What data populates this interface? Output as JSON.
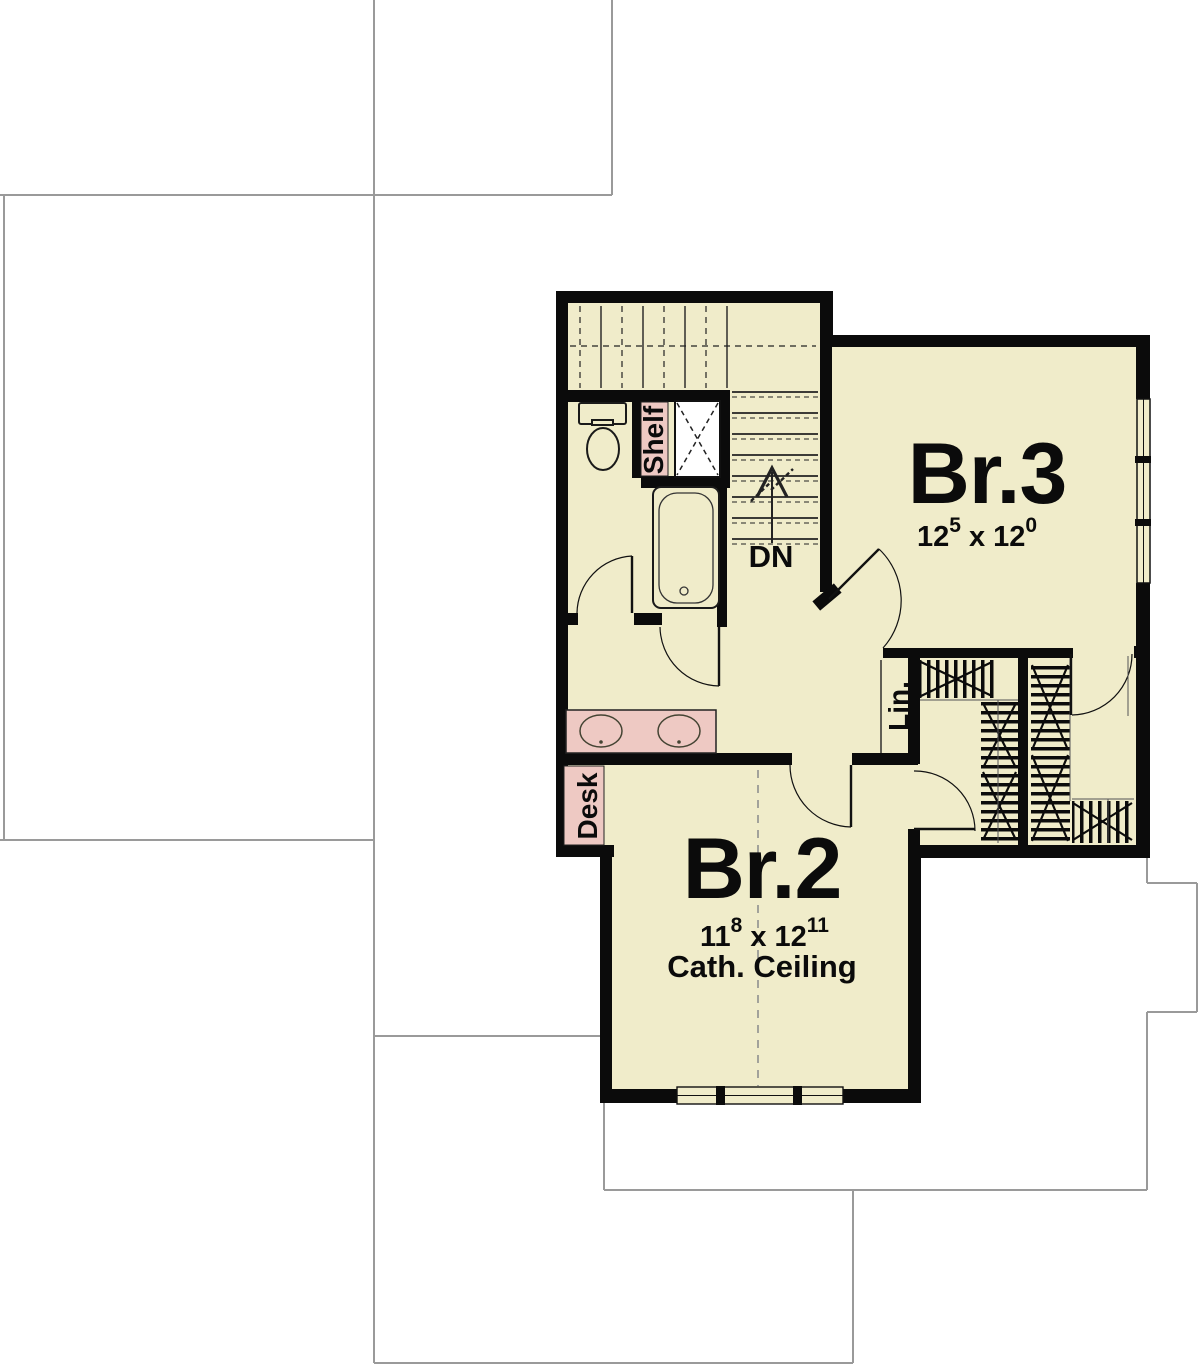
{
  "plan": {
    "rooms": {
      "br3": {
        "name": "Br.3",
        "dim_a": "12",
        "dim_a_sup": "5",
        "dim_sep": "x",
        "dim_b": "12",
        "dim_b_sup": "0"
      },
      "br2": {
        "name": "Br.2",
        "dim_a": "11",
        "dim_a_sup": "8",
        "dim_sep": "x",
        "dim_b": "12",
        "dim_b_sup": "11",
        "ceiling_note": "Cath. Ceiling"
      }
    },
    "labels": {
      "stair_direction": "DN",
      "shelf": "Shelf",
      "desk": "Desk",
      "linen_closet": "Lin."
    },
    "colors": {
      "floor_fill": "#f0ecca",
      "fixture_pink": "#eec9c3",
      "wall_black": "#0b0b0b",
      "roof_outline_gray": "#9a9a9a",
      "background": "#ffffff"
    }
  }
}
